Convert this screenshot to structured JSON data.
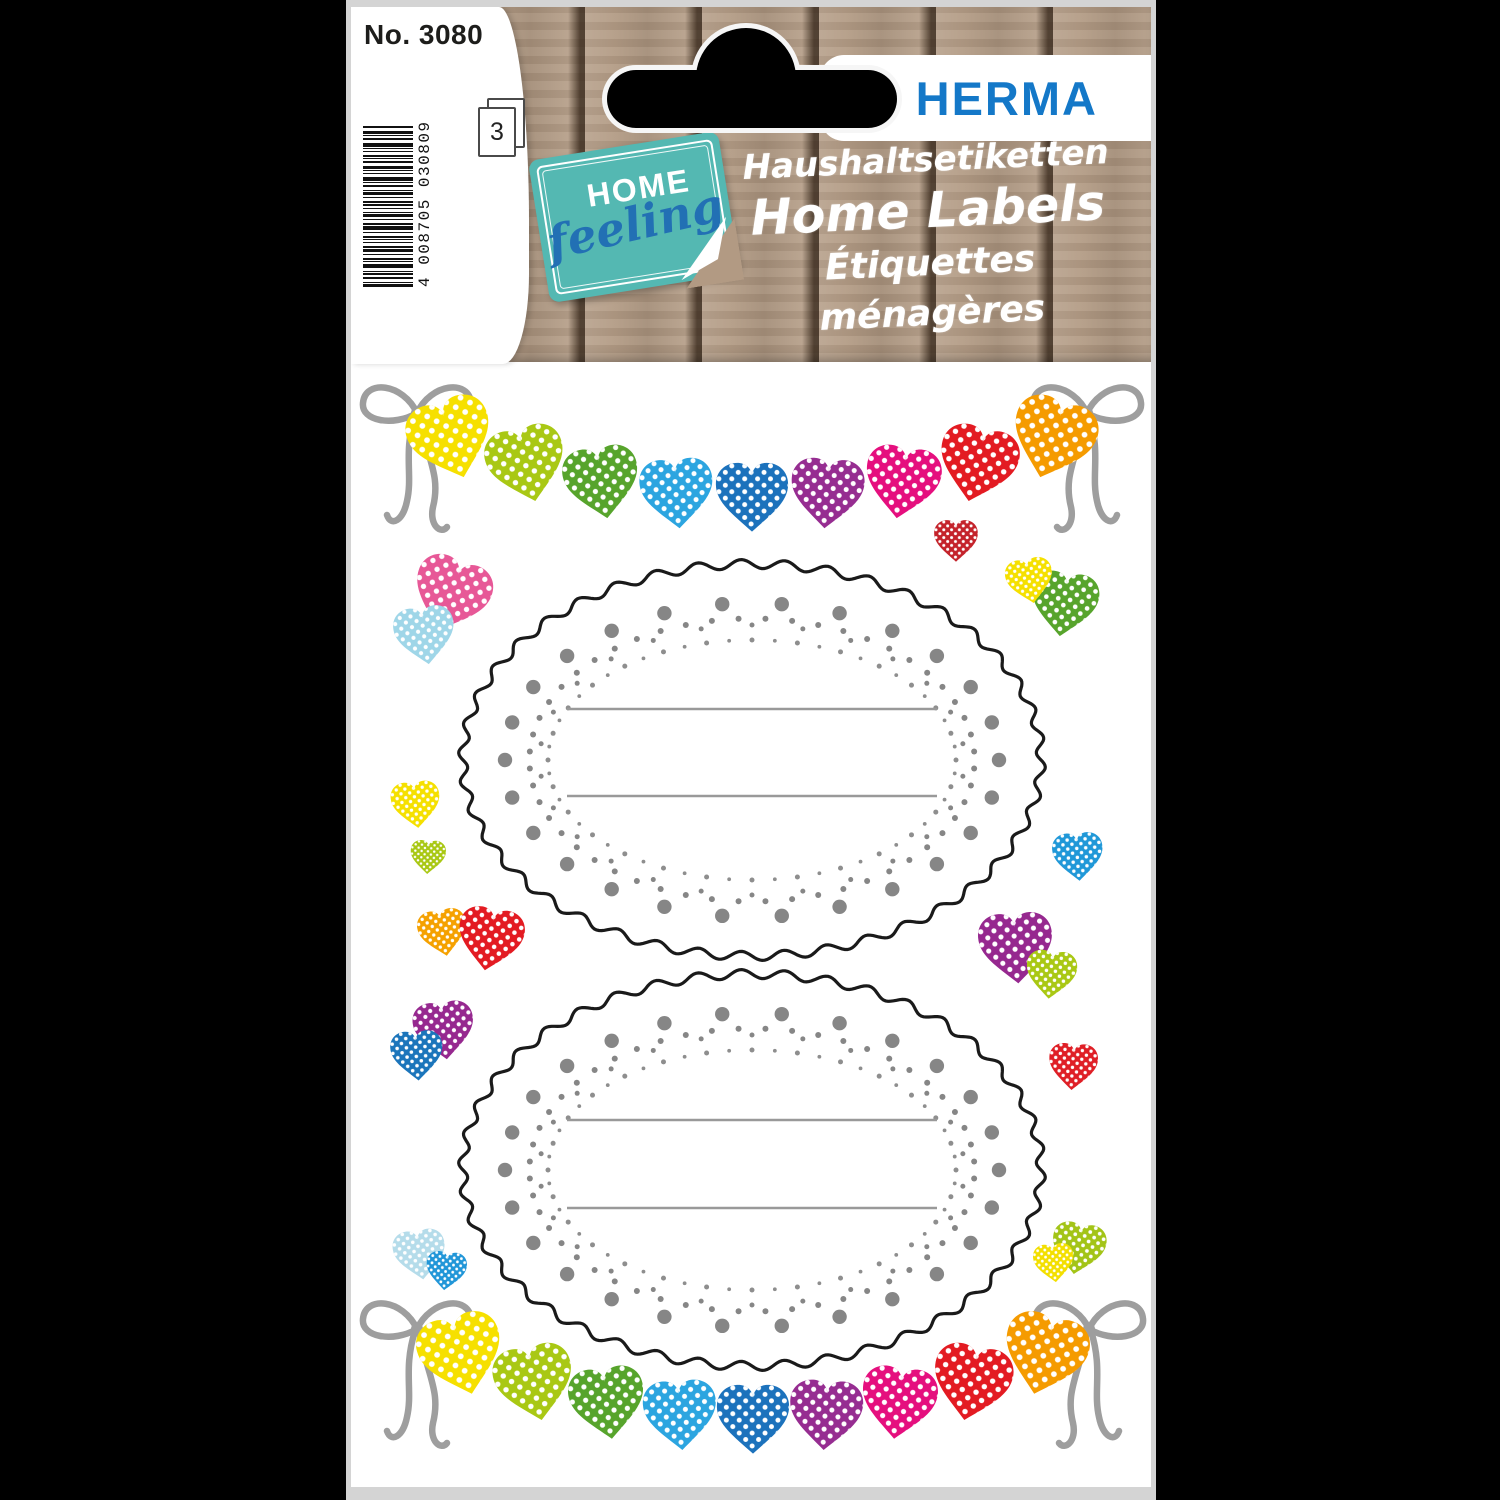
{
  "header": {
    "product_number": "No. 3080",
    "barcode": "4 008705 030809",
    "sheet_count": "3",
    "badge_home": "HOME",
    "badge_feeling": "feeling",
    "brand": "HERMA",
    "title_de": "Haushaltsetiketten",
    "title_en": "Home Labels",
    "title_fr": "Étiquettes ménagères"
  },
  "colors": {
    "background": "#000000",
    "edge_gray": "#d4d4d4",
    "wood_tan": "#b29a83",
    "badge_teal": "#54b8b2",
    "badge_script_blue": "#2270b4",
    "brand_blue": "#1478c8",
    "brand_yellow": "#fcc200",
    "bow_gray": "#9e9e9e",
    "dot_gray": "#868686",
    "line_gray": "#999999",
    "oval_stroke": "#1a1a1a"
  },
  "sheet": {
    "garland_colors": [
      "#F6E000",
      "#A9C814",
      "#57A42C",
      "#2CA5E0",
      "#1C72BC",
      "#962D91",
      "#E50F7E",
      "#E31B22",
      "#F59B00"
    ],
    "garlands": [
      {
        "x_start": 452,
        "x_end": 1052,
        "y_ends": 441,
        "y_mid": 499,
        "rot_max": 18,
        "bows": [
          [
            417,
            413,
            1
          ],
          [
            1087,
            413,
            -1
          ]
        ]
      },
      {
        "x_start": 462,
        "x_end": 1044,
        "y_ends": 1357,
        "y_mid": 1421,
        "rot_max": 15,
        "bows": [
          [
            417,
            1329,
            1
          ],
          [
            1089,
            1329,
            -1
          ]
        ]
      }
    ],
    "labels": [
      {
        "cx": 752,
        "cy": 760,
        "rx": 289,
        "ry": 196,
        "lines_y": [
          709,
          796
        ],
        "line_x": [
          567,
          937
        ]
      },
      {
        "cx": 752,
        "cy": 1170,
        "rx": 289,
        "ry": 196,
        "lines_y": [
          1120,
          1208
        ],
        "line_x": [
          567,
          937
        ]
      }
    ],
    "scattered_hearts": [
      {
        "x": 450,
        "y": 597,
        "s": 92,
        "r": 20,
        "c": "#E75897"
      },
      {
        "x": 425,
        "y": 637,
        "s": 72,
        "r": -8,
        "c": "#9FD6E8"
      },
      {
        "x": 416,
        "y": 806,
        "s": 58,
        "r": -6,
        "c": "#F5E000"
      },
      {
        "x": 428,
        "y": 858,
        "s": 42,
        "r": 3,
        "c": "#A9C814"
      },
      {
        "x": 443,
        "y": 934,
        "s": 58,
        "r": -10,
        "c": "#F5A100"
      },
      {
        "x": 490,
        "y": 941,
        "s": 78,
        "r": 10,
        "c": "#E31B22"
      },
      {
        "x": 444,
        "y": 1032,
        "s": 72,
        "r": -6,
        "c": "#96288F"
      },
      {
        "x": 417,
        "y": 1057,
        "s": 62,
        "r": -4,
        "c": "#1B75BB"
      },
      {
        "x": 420,
        "y": 1256,
        "s": 62,
        "r": -8,
        "c": "#B5DCEA"
      },
      {
        "x": 446,
        "y": 1272,
        "s": 48,
        "r": 6,
        "c": "#2196D8"
      },
      {
        "x": 956,
        "y": 542,
        "s": 52,
        "r": 0,
        "c": "#C4232B"
      },
      {
        "x": 1064,
        "y": 606,
        "s": 80,
        "r": 8,
        "c": "#57A42C"
      },
      {
        "x": 1030,
        "y": 582,
        "s": 56,
        "r": -10,
        "c": "#F5E000"
      },
      {
        "x": 1078,
        "y": 858,
        "s": 60,
        "r": -4,
        "c": "#2098D8"
      },
      {
        "x": 1016,
        "y": 950,
        "s": 88,
        "r": -4,
        "c": "#96288F"
      },
      {
        "x": 1051,
        "y": 976,
        "s": 60,
        "r": 6,
        "c": "#A9C814"
      },
      {
        "x": 1073,
        "y": 1068,
        "s": 58,
        "r": 4,
        "c": "#DF1F26"
      },
      {
        "x": 1078,
        "y": 1250,
        "s": 64,
        "r": 10,
        "c": "#A3C417"
      },
      {
        "x": 1054,
        "y": 1264,
        "s": 48,
        "r": -6,
        "c": "#F3DF00"
      }
    ]
  }
}
